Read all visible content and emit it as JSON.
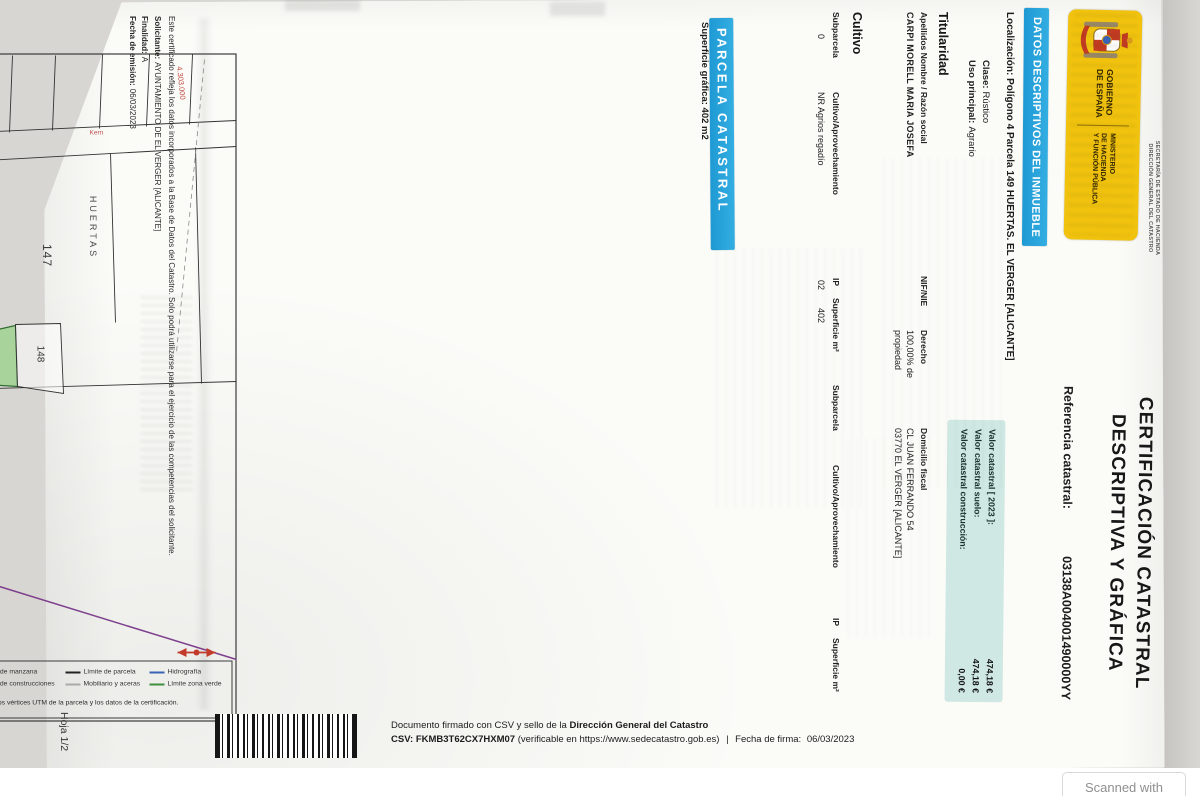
{
  "page": {
    "hoja_label": "Hoja 1/2",
    "scanned_with_label": "Scanned with"
  },
  "logo": {
    "gobierno_line1": "GOBIERNO",
    "gobierno_line2": "DE ESPAÑA",
    "ministerio_line1": "MINISTERIO",
    "ministerio_line2": "DE HACIENDA",
    "ministerio_line3": "Y FUNCIÓN PÚBLICA",
    "secretaria": "SECRETARÍA DE ESTADO DE HACIENDA",
    "direccion": "DIRECCIÓN GENERAL DEL CATASTRO",
    "brand_yellow": "#f1c30f"
  },
  "titulo": {
    "line1": "CERTIFICACIÓN CATASTRAL",
    "line2": "DESCRIPTIVA Y GRÁFICA",
    "referencia_label": "Referencia catastral:",
    "referencia_value": "03138A004001490000YY"
  },
  "datos_inmueble": {
    "section_title": "DATOS DESCRIPTIVOS DEL INMUEBLE",
    "section_color": "#29a5de",
    "localizacion_label": "Localización:",
    "localizacion_value": "Polígono 4 Parcela 149 HUERTAS. EL VERGER [ALICANTE]",
    "clase_label": "Clase:",
    "clase_value": "Rústico",
    "uso_label": "Uso principal:",
    "uso_value": "Agrario",
    "valor_bg": "#cfe8e3",
    "valor_rows": [
      {
        "label": "Valor catastral  [ 2023 ]:",
        "value": "474,18 €"
      },
      {
        "label": "Valor catastral suelo:",
        "value": "474,18 €"
      },
      {
        "label": "Valor catastral construcción:",
        "value": "0,00 €"
      }
    ]
  },
  "titularidad": {
    "section_title": "Titularidad",
    "col_apellidos": "Apellidos Nombre / Razón social",
    "col_nif": "NIF/NIE",
    "col_derecho": "Derecho",
    "col_domicilio": "Domicilio fiscal",
    "apellidos_value": "CARPI MORELL MARIA JOSEFA",
    "nif_value": "",
    "derecho_value": "100,00% de propiedad",
    "domicilio_line1": "CL JUAN FERRANDO 54",
    "domicilio_line2": "03770 EL VERGER [ALICANTE]"
  },
  "cultivo": {
    "section_title": "Cultivo",
    "headers": [
      "Subparcela",
      "Cultivo/Aprovechamiento",
      "IP",
      "Superficie m²",
      "Subparcela",
      "Cultivo/Aprovechamiento",
      "IP",
      "Superficie m²"
    ],
    "row": {
      "subparcela": "0",
      "aprovechamiento": "NR Agrios regadío",
      "ip": "02",
      "superficie": "402"
    }
  },
  "parcela": {
    "section_title": "PARCELA CATASTRAL",
    "superficie_label": "Superficie gráfica:",
    "superficie_value": "402 m2",
    "escala_line1": "Escala",
    "escala_line2": "1/1500",
    "map": {
      "labels": {
        "p147": "147",
        "p148": "148",
        "p149": "149",
        "p150": "150",
        "zona": "HUERTAS",
        "road": "Kern"
      },
      "axis_left": [
        "240.150",
        "240.200",
        "240.250",
        "240.300",
        "240.350"
      ],
      "axis_top": [
        "4.303.050",
        "4.303.000"
      ],
      "highlight_fill": "#a8d49c"
    },
    "legend": {
      "coords_note": "240.350 Coordenadas U.T.M. Huso 31 ETRS89",
      "items": [
        {
          "label": "Límite de manzana",
          "color": "#c0392b"
        },
        {
          "label": "Límite de construcciones",
          "color": "#999999"
        },
        {
          "label": "Límite de parcela",
          "color": "#222222"
        },
        {
          "label": "Mobiliario y aceras",
          "color": "#aaaaaa"
        },
        {
          "label": "Hidrografía",
          "color": "#3a62b5"
        },
        {
          "label": "Límite zona verde",
          "color": "#3f8f3f"
        }
      ],
      "disclaimer": "Esta cartografía solo podrá utilizarse junto con las coordenadas de los vértices UTM de la parcela y los datos de la certificación."
    }
  },
  "footer_cert": {
    "line1": "Este certificado refleja los datos incorporados a la Base de Datos del Catastro. Solo podrá utilizarse para el ejercicio de las competencias del solicitante.",
    "solicitante_label": "Solicitante:",
    "solicitante_value": "AYUNTAMIENTO DE EL VERGER [ALICANTE]",
    "finalidad_label": "Finalidad:",
    "finalidad_value": "A",
    "fecha_label": "Fecha de emisión:",
    "fecha_value": "06/03/2023"
  },
  "firma": {
    "line1_prefix": "Documento firmado con CSV y sello de la ",
    "line1_bold": "Dirección General del Catastro",
    "csv_label": "CSV: ",
    "csv_value": "FKMB3T62CX7HXM07",
    "line2_rest": " (verificable en https://www.sedecatastro.gob.es)",
    "separator": "|",
    "fecha_firma_label": "Fecha de firma:",
    "fecha_firma_value": "06/03/2023"
  }
}
